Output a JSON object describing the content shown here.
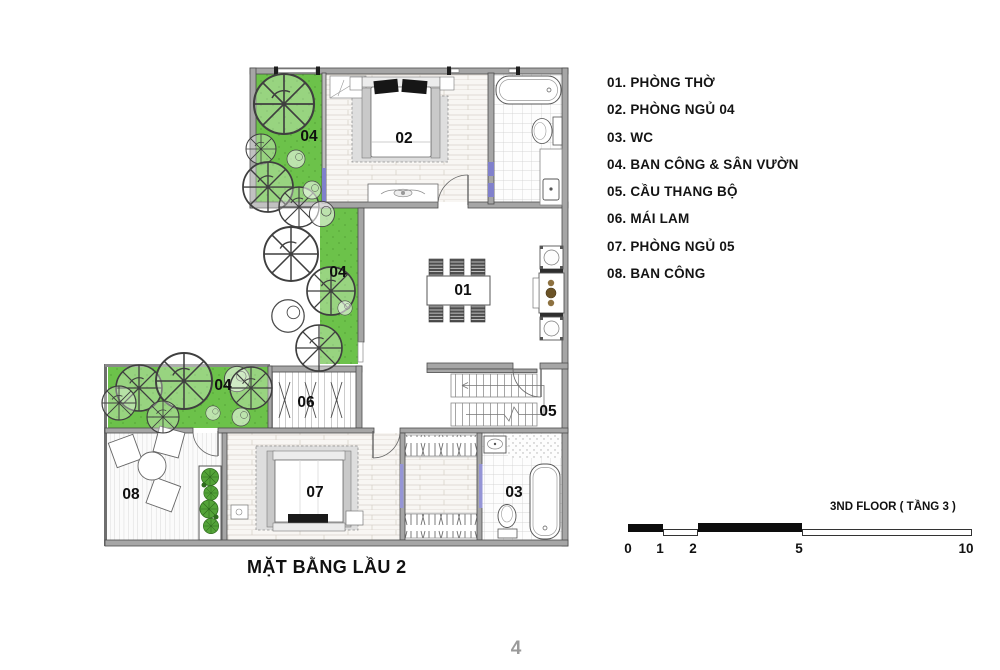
{
  "plan": {
    "title": "MẶT BẰNG LẦU 2",
    "labels": {
      "balcony_top": "04",
      "bedroom_02": "02",
      "garden_mid": "04",
      "worship_room": "01",
      "garden_bottom": "04",
      "mai_lam": "06",
      "stairs": "05",
      "balcony_08": "08",
      "bedroom_07": "07",
      "wc": "03"
    }
  },
  "legend": {
    "items": [
      "01. PHÒNG THỜ",
      "02. PHÒNG NGỦ 04",
      "03. WC",
      "04. BAN CÔNG & SÂN VƯỜN",
      "05. CẦU THANG BỘ",
      "06. MÁI LAM",
      "07. PHÒNG NGỦ 05",
      "08. BAN CÔNG"
    ]
  },
  "scale_bar": {
    "title": "3ND FLOOR ( TẦNG 3 )",
    "ticks": [
      "0",
      "1",
      "2",
      "5",
      "10"
    ]
  },
  "page": {
    "number": "4"
  },
  "colors": {
    "garden_green": "#6cc24a",
    "wall_gray": "#a6a6a6",
    "door_marker_blue": "#8080cc",
    "page_number_gray": "#9a9a9a"
  }
}
